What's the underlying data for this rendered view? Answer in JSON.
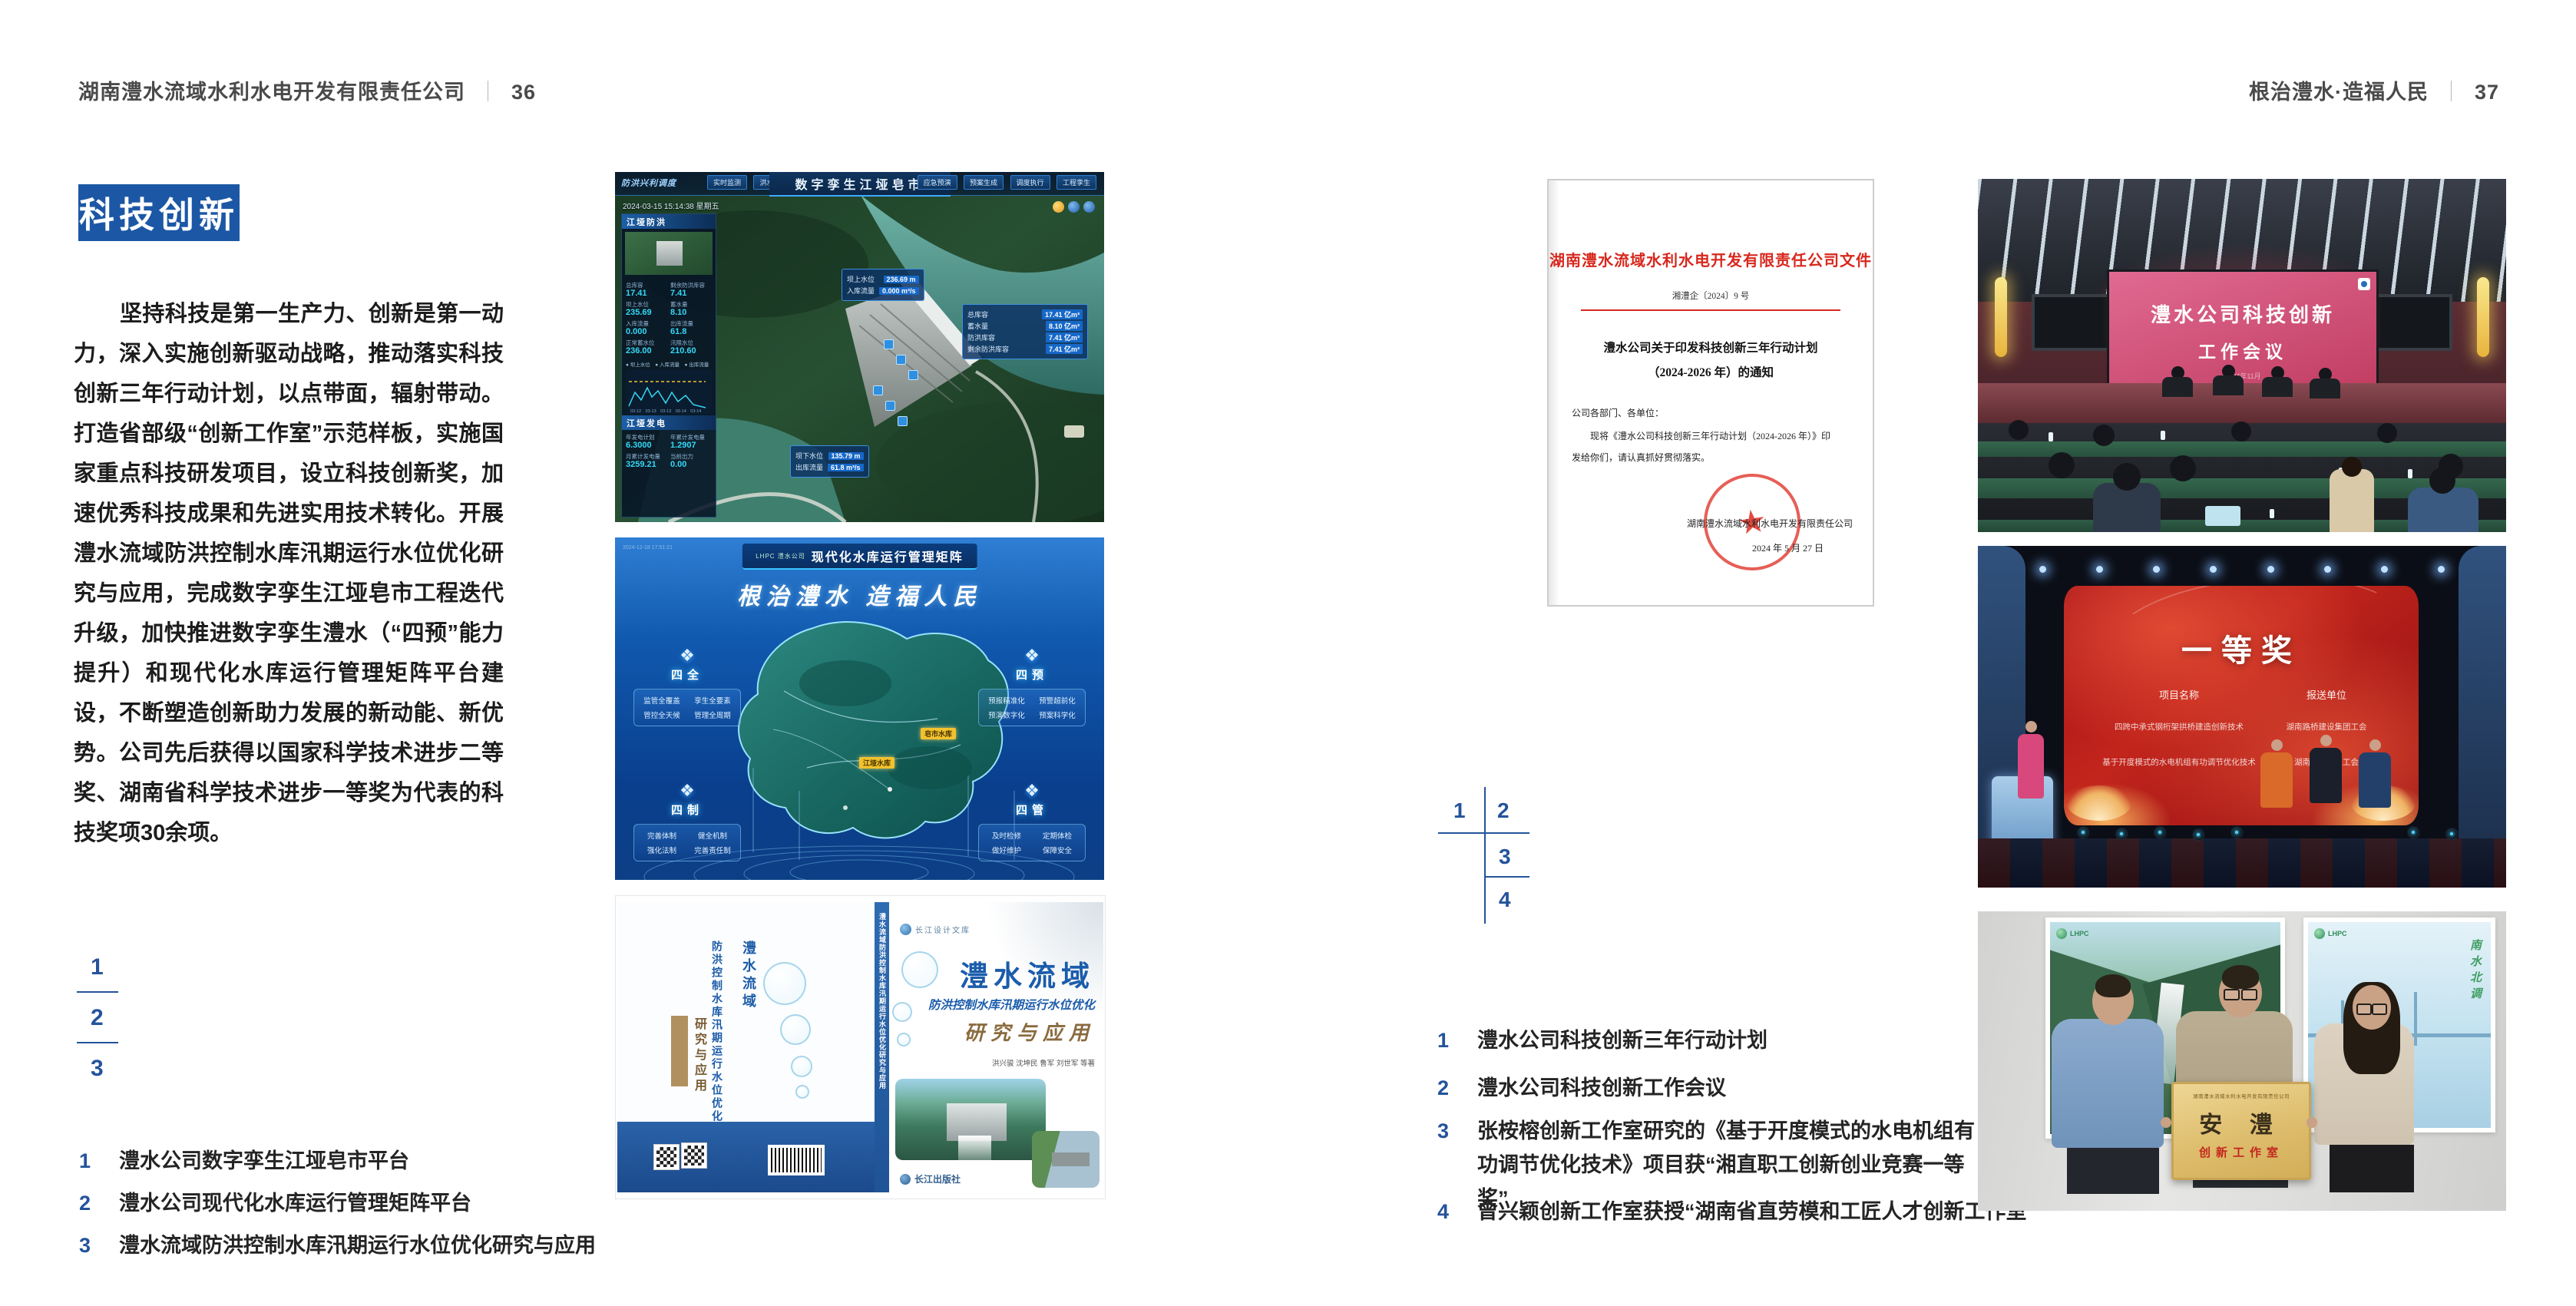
{
  "page": {
    "left_header": {
      "company": "湖南澧水流域水利水电开发有限责任公司",
      "divider": "｜",
      "page_no": "36"
    },
    "right_header": {
      "motto": "根治澧水·造福人民",
      "divider": "｜",
      "page_no": "37"
    }
  },
  "left": {
    "badge": "科技创新",
    "paragraph": "坚持科技是第一生产力、创新是第一动力，深入实施创新驱动战略，推动落实科技创新三年行动计划，以点带面，辐射带动。打造省部级“创新工作室”示范样板，实施国家重点科技研发项目，设立科技创新奖，加速优秀科技成果和先进实用技术转化。开展澧水流域防洪控制水库汛期运行水位优化研究与应用，完成数字孪生江垭皂市工程迭代升级，加快推进数字孪生澧水（“四预”能力提升）和现代化水库运行管理矩阵平台建设，不断塑造创新助力发展的新动能、新优势。公司先后获得以国家科学技术进步二等奖、湖南省科学技术进步一等奖为代表的科技奖项30余项。",
    "index": [
      "1",
      "2",
      "3"
    ],
    "captions": [
      {
        "n": "1",
        "t": "澧水公司数字孪生江垭皂市平台"
      },
      {
        "n": "2",
        "t": "澧水公司现代化水库运行管理矩阵平台"
      },
      {
        "n": "3",
        "t": "澧水流域防洪控制水库汛期运行水位优化研究与应用"
      }
    ]
  },
  "right": {
    "index": [
      "1",
      "2",
      "3",
      "4"
    ],
    "captions": [
      {
        "n": "1",
        "t": "澧水公司科技创新三年行动计划"
      },
      {
        "n": "2",
        "t": "澧水公司科技创新工作会议"
      },
      {
        "n": "3",
        "t": "张桉榕创新工作室研究的《基于开度模式的水电机组有功调节优化技术》项目获“湘直职工创新创业竞赛一等奖”"
      },
      {
        "n": "4",
        "t": "曾兴颖创新工作室获授“湖南省直劳模和工匠人才创新工作室”"
      }
    ]
  },
  "twin": {
    "corner": "防洪兴利调度",
    "title": "数字孪生江垭皂市",
    "tabs_left": [
      "实时监测",
      "洪水预报",
      "防洪预警"
    ],
    "tabs_right": [
      "应急预演",
      "预案生成",
      "调度执行",
      "工程孪生"
    ],
    "datetime": "2024-03-15 15:14:38 星期五",
    "p1": "江垭防洪",
    "s1": [
      {
        "l": "总库容",
        "v": "17.41"
      },
      {
        "l": "剩余防洪库容",
        "v": "7.41"
      },
      {
        "l": "坝上水位",
        "v": "235.69"
      },
      {
        "l": "蓄水量",
        "v": "8.10"
      },
      {
        "l": "入库流量",
        "v": "0.000"
      },
      {
        "l": "出库流量",
        "v": "61.8"
      },
      {
        "l": "正常蓄水位",
        "v": "236.00"
      },
      {
        "l": "汛限水位",
        "v": "210.60"
      }
    ],
    "legend": "● 坝上水位　● 入库流量　● 出库流量",
    "axis": "03-12　03-13　03-13　03-14　03-14",
    "p2": "江垭发电",
    "s2": [
      {
        "l": "年发电计划",
        "v": "6.3000"
      },
      {
        "l": "年累计发电量",
        "v": "1.2907"
      },
      {
        "l": "月累计发电量",
        "v": "3259.21"
      },
      {
        "l": "当前出力",
        "v": "0.00"
      }
    ],
    "c1": [
      {
        "l": "坝上水位",
        "v": "236.69 m"
      },
      {
        "l": "入库流量",
        "v": "0.000 m³/s"
      }
    ],
    "c2": [
      {
        "l": "总库容",
        "v": "17.41 亿m³"
      },
      {
        "l": "蓄水量",
        "v": "8.10 亿m³"
      },
      {
        "l": "防洪库容",
        "v": "7.41 亿m³"
      },
      {
        "l": "剩余防洪库容",
        "v": "7.41 亿m³"
      }
    ],
    "c3": [
      {
        "l": "坝下水位",
        "v": "135.79 m"
      },
      {
        "l": "出库流量",
        "v": "61.8 m³/s"
      }
    ]
  },
  "matrix": {
    "brand": "LHPC 澧水公司",
    "title": "现代化水库运行管理矩阵",
    "timestamp": "2024-12-18 17:51:21",
    "slogan": "根治澧水 造福人民",
    "icon_glyph": "❖",
    "groups": [
      {
        "name": "四全",
        "items": [
          "监管全覆盖",
          "孪生全要素",
          "管控全天候",
          "管理全周期"
        ]
      },
      {
        "name": "四预",
        "items": [
          "预报精准化",
          "预警超前化",
          "预演数字化",
          "预案科学化"
        ]
      },
      {
        "name": "四制",
        "items": [
          "完善体制",
          "健全机制",
          "强化法制",
          "完善责任制"
        ]
      },
      {
        "name": "四管",
        "items": [
          "及时检修",
          "定期体检",
          "做好维护",
          "保障安全"
        ]
      }
    ],
    "markers": [
      "江垭水库",
      "皂市水库"
    ]
  },
  "book": {
    "series": "长江设计文库",
    "t1": "澧水流域",
    "t2": "防洪控制水库汛期运行水位优化",
    "t3": "研究与应用",
    "authors": "洪兴骏 沈坤民 鲁军 刘世军 等著",
    "publisher": "长江出版社",
    "spine": "澧水流域防洪控制水库汛期运行水位优化研究与应用",
    "back_t1": "澧水流域",
    "back_t2": "防洪控制水库汛期运行水位优化",
    "back_t3": "研究与应用"
  },
  "doc": {
    "header": "湖南澧水流域水利水电开发有限责任公司文件",
    "no": "湘澧企〔2024〕9 号",
    "t1": "澧水公司关于印发科技创新三年行动计划",
    "t2": "（2024-2026 年）的通知",
    "salute": "公司各部门、各单位：",
    "b1": "现将《澧水公司科技创新三年行动计划（2024-2026 年）》印",
    "b2": "发给你们，请认真抓好贯彻落实。",
    "sign": "湖南澧水流域水利水电开发有限责任公司",
    "date": "2024 年 5 月 27 日",
    "seal_star": "★"
  },
  "meeting": {
    "l1": "澧水公司科技创新",
    "l2": "工作会议",
    "date": "2024年11月"
  },
  "award": {
    "title": "一等奖",
    "col1": "项目名称",
    "col2": "报送单位",
    "r1a": "四跨中承式钢桁架拱桥建造创新技术",
    "r1b": "湖南路桥建设集团工会",
    "r2a": "基于开度模式的水电机组有功调节优化技术",
    "r2b": "湖南澧水公司工会"
  },
  "plaque": {
    "brand": "LHPC",
    "script": "南水北调",
    "top": "湖南澧水流域水利水电开发有限责任公司",
    "main": "安  澧",
    "sub": "创新工作室"
  }
}
